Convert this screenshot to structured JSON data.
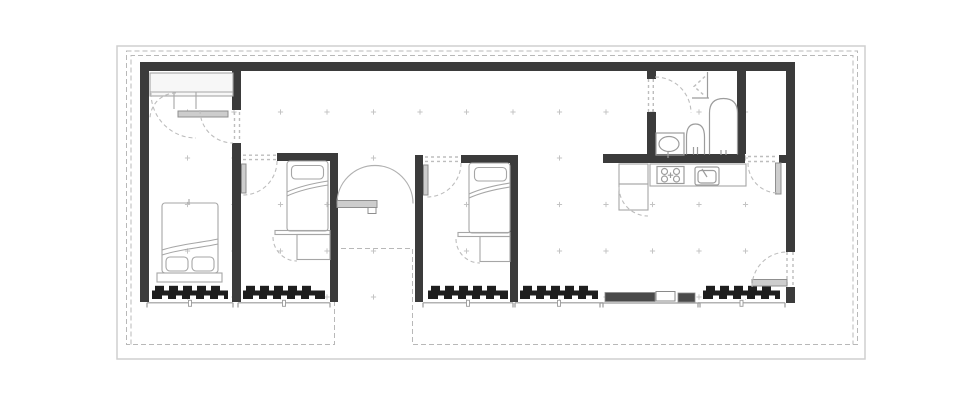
{
  "document": {
    "kind": "architectural-floor-plan",
    "view": "top-down single-storey house plan",
    "visible_text": "none"
  },
  "palette": {
    "background": "#ffffff",
    "wall": "#3b3b3b",
    "window_shutter": "#1e1e1e",
    "furniture_line": "#a6a6a6",
    "fixture_line": "#9c9c9c",
    "door_swing": "#bdbdbd",
    "boundary_dash": "#b8b8b8",
    "outer_frame": "#cfcfcf",
    "door_leaf": "#cdcdcd",
    "sliding_panel": "#4a4a4a",
    "grid_cross": "#c4c4c4"
  },
  "rooms": [
    {
      "id": "bedroom-1",
      "furniture": [
        "wardrobe",
        "double-bed",
        "hinged-door"
      ]
    },
    {
      "id": "bedroom-2",
      "furniture": [
        "single-bed",
        "desk-cabinet",
        "hinged-door"
      ]
    },
    {
      "id": "entry-hall",
      "furniture": [
        "pivot-entry-door"
      ]
    },
    {
      "id": "bedroom-3",
      "furniture": [
        "single-bed",
        "desk-cabinet",
        "hinged-door"
      ]
    },
    {
      "id": "living-kitchen",
      "furniture": [
        "kitchen-counter",
        "stove",
        "kitchen-sink",
        "fridge-cabinet",
        "sliding-glass-door",
        "side-entry-door"
      ]
    },
    {
      "id": "bathroom",
      "furniture": [
        "wash-basin",
        "toilet",
        "bathtub",
        "bifold-niche-door",
        "hinged-door"
      ]
    },
    {
      "id": "storage-closet",
      "furniture": [
        "hinged-door"
      ]
    }
  ],
  "grid_marks": {
    "xs": [
      187.5,
      234,
      280.5,
      327,
      373.5,
      420,
      466.5,
      513,
      559.5,
      606,
      652.5,
      699,
      745.5
    ],
    "ys": [
      112,
      158,
      204.5,
      251,
      297
    ],
    "arm": 2.6
  },
  "windows": [
    {
      "x": 152,
      "w": 76
    },
    {
      "x": 243,
      "w": 82
    },
    {
      "x": 428,
      "w": 80
    },
    {
      "x": 520,
      "w": 78
    },
    {
      "x": 703,
      "w": 77
    }
  ]
}
